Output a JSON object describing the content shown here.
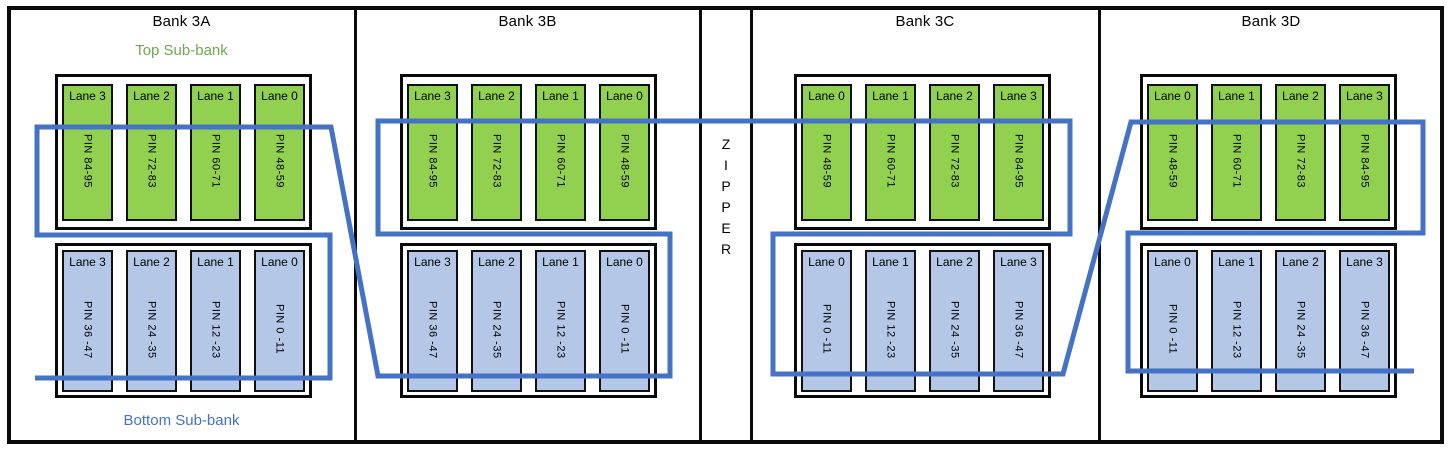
{
  "labels": {
    "top_subbank": "Top Sub-bank",
    "bottom_subbank": "Bottom Sub-bank",
    "zipper": "ZIPPER"
  },
  "colors": {
    "lane_green": "#92D050",
    "lane_blue": "#B4C7E7",
    "route_line": "#4472C4",
    "top_subbank_label": "#6FA84F",
    "bottom_subbank_label": "#4472C4",
    "border_black": "#0a0a0a"
  },
  "banks": [
    {
      "name": "Bank 3A",
      "top_lanes": [
        {
          "label": "Lane 3",
          "pin": "PIN 84-95"
        },
        {
          "label": "Lane 2",
          "pin": "PIN 72-83"
        },
        {
          "label": "Lane 1",
          "pin": "PIN 60-71"
        },
        {
          "label": "Lane 0",
          "pin": "PIN 48-59"
        }
      ],
      "bottom_lanes": [
        {
          "label": "Lane 3",
          "pin": "PIN 36 -47"
        },
        {
          "label": "Lane 2",
          "pin": "PIN 24 -35"
        },
        {
          "label": "Lane 1",
          "pin": "PIN 12 -23"
        },
        {
          "label": "Lane 0",
          "pin": "PIN 0 -11"
        }
      ]
    },
    {
      "name": "Bank 3B",
      "top_lanes": [
        {
          "label": "Lane 3",
          "pin": "PIN 84-95"
        },
        {
          "label": "Lane 2",
          "pin": "PIN 72-83"
        },
        {
          "label": "Lane 1",
          "pin": "PIN 60-71"
        },
        {
          "label": "Lane 0",
          "pin": "PIN 48-59"
        }
      ],
      "bottom_lanes": [
        {
          "label": "Lane 3",
          "pin": "PIN 36 -47"
        },
        {
          "label": "Lane 2",
          "pin": "PIN 24 -35"
        },
        {
          "label": "Lane 1",
          "pin": "PIN 12 -23"
        },
        {
          "label": "Lane 0",
          "pin": "PIN 0 -11"
        }
      ]
    },
    {
      "name": "Bank 3C",
      "top_lanes": [
        {
          "label": "Lane 0",
          "pin": "PIN 48-59"
        },
        {
          "label": "Lane 1",
          "pin": "PIN 60-71"
        },
        {
          "label": "Lane 2",
          "pin": "PIN 72-83"
        },
        {
          "label": "Lane 3",
          "pin": "PIN 84-95"
        }
      ],
      "bottom_lanes": [
        {
          "label": "Lane 0",
          "pin": "PIN 0 -11"
        },
        {
          "label": "Lane 1",
          "pin": "PIN 12 -23"
        },
        {
          "label": "Lane 2",
          "pin": "PIN 24 -35"
        },
        {
          "label": "Lane 3",
          "pin": "PIN 36 -47"
        }
      ]
    },
    {
      "name": "Bank 3D",
      "top_lanes": [
        {
          "label": "Lane 0",
          "pin": "PIN 48-59"
        },
        {
          "label": "Lane 1",
          "pin": "PIN 60-71"
        },
        {
          "label": "Lane 2",
          "pin": "PIN 72-83"
        },
        {
          "label": "Lane 3",
          "pin": "PIN 84-95"
        }
      ],
      "bottom_lanes": [
        {
          "label": "Lane 0",
          "pin": "PIN 0 -11"
        },
        {
          "label": "Lane 1",
          "pin": "PIN 12 -23"
        },
        {
          "label": "Lane 2",
          "pin": "PIN 24 -35"
        },
        {
          "label": "Lane 3",
          "pin": "PIN 36 -47"
        }
      ]
    }
  ]
}
